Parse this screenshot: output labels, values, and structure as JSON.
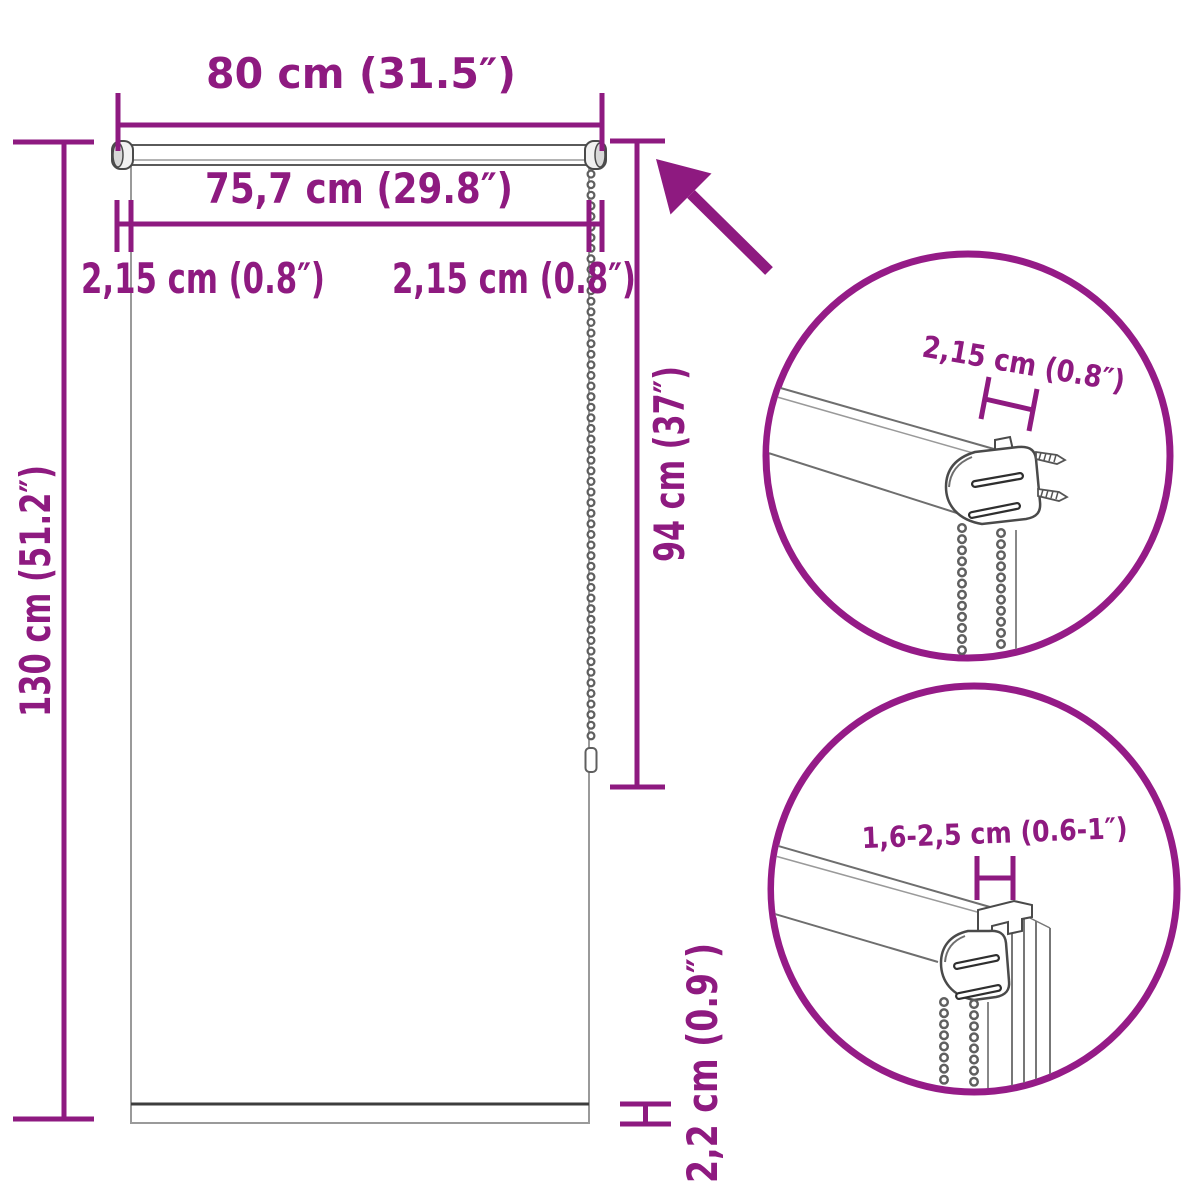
{
  "colors": {
    "accent_purple": "#8E1A80",
    "circle_purple": "#951B87",
    "drawing_gray": "#6E6E6E",
    "light_gray": "#9A9A9A",
    "bottom_bar_gray": "#3D3D3D",
    "background": "#FFFFFF"
  },
  "icons": {
    "arrow": "zoom-detail-arrow"
  },
  "main_view": {
    "width_outer_label": "80 cm (31.5″)",
    "width_inner_label": "75,7 cm (29.8″)",
    "offset_left_label": "2,15 cm (0.8″)",
    "offset_right_label": "2,15 cm (0.8″)",
    "height_total_label": "130 cm (51.2″)",
    "height_drop_label": "94 cm (37″)",
    "bottom_bar_label": "2,2 cm (0.9″)"
  },
  "detail_top": {
    "bracket_depth_label": "2,15 cm (0.8″)"
  },
  "detail_bottom": {
    "clamp_range_label": "1,6-2,5 cm (0.6-1″)"
  }
}
